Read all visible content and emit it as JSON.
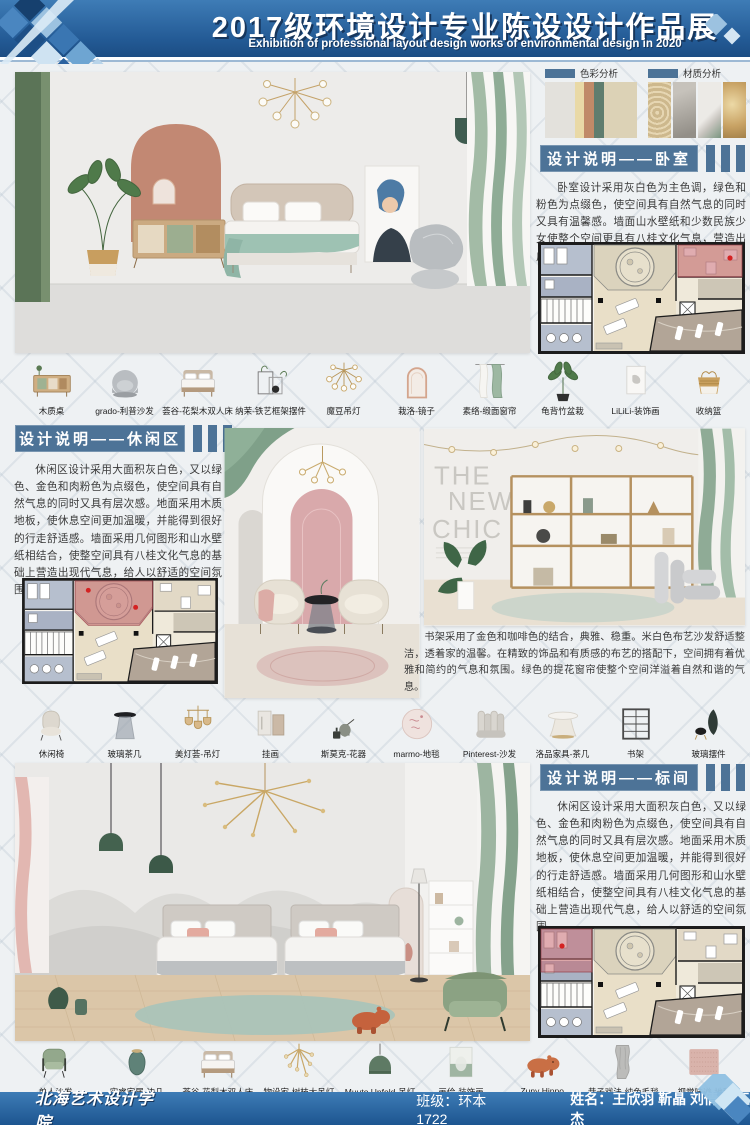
{
  "header": {
    "title": "2017级环境设计专业陈设设计作品展",
    "subtitle": "Exhibition of professional layout design works of environmental design in 2020"
  },
  "analysis": {
    "color_label": "色彩分析",
    "material_label": "材质分析",
    "color_swatches": [
      "#e3e1dc",
      "#e9d9a6",
      "#c08a68",
      "#5f7d6e",
      "#dcd2b6"
    ]
  },
  "sections": {
    "bedroom": {
      "title": "设计说明——卧室",
      "body": "卧室设计采用灰白色为主色调，绿色和粉色为点缀色，使空间具有自然气息的同时又具有温馨感。墙面山水壁纸和少数民族少女使整个空间更具有八桂文化气息，营造出广西文化的良好氛围。"
    },
    "leisure": {
      "title": "设计说明——休闲区",
      "body": "休闲区设计采用大面积灰白色，又以绿色、金色和肉粉色为点缀色，使空间具有自然气息的同时又具有层次感。地面采用木质地板，使休息空间更加温暖，并能得到很好的行走舒适感。墙面采用几何图形和山水壁纸相结合，使整空间具有八桂文化气息的基础上营造出现代气息，给人以舒适的空间氛围。"
    },
    "standard": {
      "title": "设计说明——标间",
      "body": "休闲区设计采用大面积灰白色，又以绿色、金色和肉粉色为点缀色，使空间具有自然气息的同时又具有层次感。地面采用木质地板，使休息空间更加温暖，并能得到很好的行走舒适感。墙面采用几何图形和山水壁纸相结合，使整空间具有八桂文化气息的基础上营造出现代气息，给人以舒适的空间氛围。"
    },
    "bookshelf_note": "书架采用了金色和咖啡色的结合，典雅、稳重。米白色布艺沙发舒适整洁，透着家的温馨。在精致的饰品和有质感的布艺的搭配下，空间拥有着优雅和简约的气息和氛围。绿色的提花窗帘使整个空间洋溢着自然和谐的气息。"
  },
  "shelf_wall": {
    "line1": "THE",
    "line2": "NEW",
    "line3": "CHIC"
  },
  "furniture": {
    "row1": [
      {
        "label": "木质桌",
        "icon": "wood-cabinet-icon"
      },
      {
        "label": "grado-利普沙发",
        "icon": "round-sofa-icon"
      },
      {
        "label": "荟谷-花梨木双人床",
        "icon": "double-bed-icon"
      },
      {
        "label": "纳茉-铁艺框架摆件",
        "icon": "iron-frame-icon"
      },
      {
        "label": "魔豆吊灯",
        "icon": "chandelier-icon"
      },
      {
        "label": "栽洛-镜子",
        "icon": "arch-mirror-icon"
      },
      {
        "label": "素络-缎面窗帘",
        "icon": "curtain-icon"
      },
      {
        "label": "龟背竹盆栽",
        "icon": "plant-icon"
      },
      {
        "label": "LiLiLi-装饰画",
        "icon": "art-print-icon"
      },
      {
        "label": "收纳篮",
        "icon": "basket-icon"
      }
    ],
    "row2": [
      {
        "label": "休闲椅",
        "icon": "lounge-chair-icon"
      },
      {
        "label": "玻璃茶几",
        "icon": "glass-table-icon"
      },
      {
        "label": "美灯荟-吊灯",
        "icon": "pendant-cluster-icon"
      },
      {
        "label": "挂画",
        "icon": "hanging-art-icon"
      },
      {
        "label": "斯莫克-花器",
        "icon": "flower-vase-icon"
      },
      {
        "label": "marmo-地毯",
        "icon": "round-rug-icon"
      },
      {
        "label": "Pinterest-沙发",
        "icon": "ribbed-sofa-icon"
      },
      {
        "label": "洛品家具-茶几",
        "icon": "round-table-icon"
      },
      {
        "label": "书架",
        "icon": "bookshelf-icon"
      },
      {
        "label": "玻璃摆件",
        "icon": "glass-ornament-icon"
      }
    ],
    "row3": [
      {
        "label": "单人沙发",
        "icon": "armchair-icon"
      },
      {
        "label": "实睿家居-边几",
        "icon": "vase-side-table-icon"
      },
      {
        "label": "荟谷-花梨木双人床",
        "icon": "double-bed-icon"
      },
      {
        "label": "物设家-树枝大吊灯",
        "icon": "branch-chandelier-icon"
      },
      {
        "label": "Muuto Unfold-吊灯",
        "icon": "dome-pendant-icon"
      },
      {
        "label": "画佮-装饰画",
        "icon": "abstract-art-icon"
      },
      {
        "label": "Zuny Hippo",
        "icon": "hippo-icon"
      },
      {
        "label": "巷子戏法-纯色毛毯",
        "icon": "blanket-icon"
      },
      {
        "label": "视觉味道-地毯",
        "icon": "pink-rug-icon"
      }
    ]
  },
  "footer": {
    "school": "北海艺术设计学院",
    "class_label": "班级：",
    "class_value": "环本1722",
    "names_label": "姓名：",
    "names_value": "王欣羽 靳晶 刘倩 刘玉杰"
  },
  "colors": {
    "header_blue": "#2f6fae",
    "section_blue": "#4d7397",
    "highlight_pink": "#c97f87"
  }
}
